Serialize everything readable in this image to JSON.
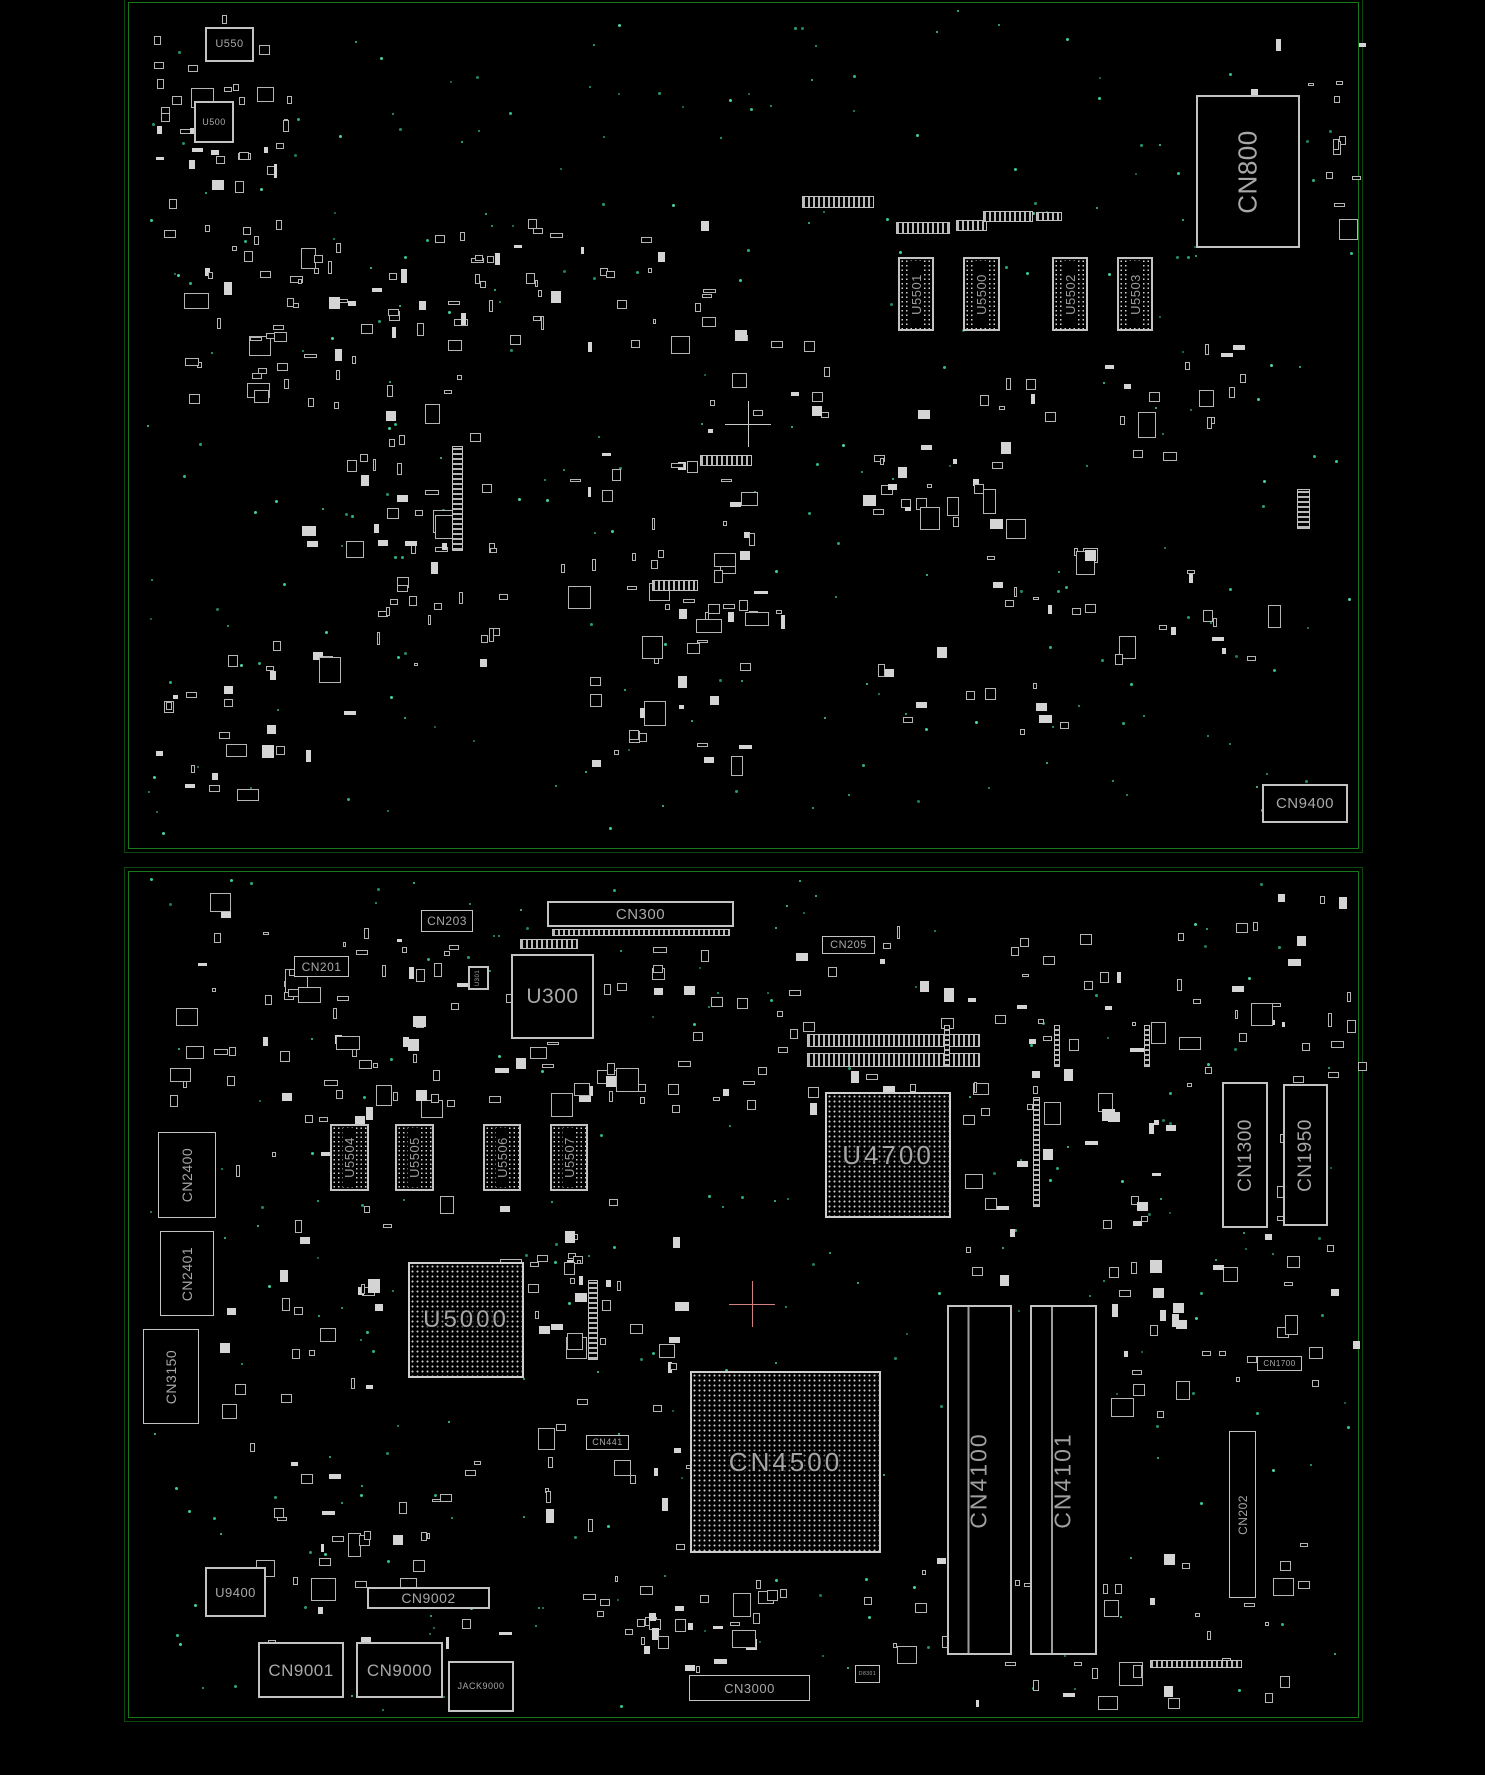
{
  "colors": {
    "background": "#000000",
    "frame_green": "#16781b",
    "frame_green_dim": "#0b470e",
    "component_gray": "#c3c3c3",
    "label_gray": "#a8a8a8",
    "via_teal": "#2fa37a",
    "crosshair_top": "#c7cbc7",
    "crosshair_bottom": "#d4827e"
  },
  "boards": [
    {
      "name": "top-board",
      "frame": {
        "x": 128,
        "y": 2,
        "w": 1229,
        "h": 845
      },
      "crosshair": {
        "x": 748,
        "y": 424,
        "color": "#c7cbc7"
      },
      "components": [
        {
          "id": "u550",
          "label": "U550",
          "type": "chip",
          "x": 205,
          "y": 27,
          "w": 49,
          "h": 35,
          "fs": 11,
          "o": "h"
        },
        {
          "id": "u500",
          "label": "U500",
          "type": "chip",
          "x": 194,
          "y": 101,
          "w": 40,
          "h": 42,
          "fs": 9,
          "o": "h"
        },
        {
          "id": "cn800",
          "label": "CN800",
          "type": "conn",
          "x": 1196,
          "y": 95,
          "w": 104,
          "h": 153,
          "fs": 26,
          "o": "v",
          "bw": 2
        },
        {
          "id": "u5501",
          "label": "U5501",
          "type": "dimm",
          "x": 898,
          "y": 257,
          "w": 36,
          "h": 74,
          "fs": 13,
          "o": "v"
        },
        {
          "id": "u5500",
          "label": "U5500",
          "type": "dimm",
          "x": 963,
          "y": 257,
          "w": 37,
          "h": 74,
          "fs": 13,
          "o": "v"
        },
        {
          "id": "u5502",
          "label": "U5502",
          "type": "dimm",
          "x": 1052,
          "y": 257,
          "w": 36,
          "h": 74,
          "fs": 13,
          "o": "v"
        },
        {
          "id": "u5503",
          "label": "U5503",
          "type": "dimm",
          "x": 1117,
          "y": 257,
          "w": 36,
          "h": 74,
          "fs": 13,
          "o": "v"
        },
        {
          "id": "cn9400",
          "label": "CN9400",
          "type": "conn",
          "x": 1262,
          "y": 784,
          "w": 86,
          "h": 39,
          "fs": 15,
          "o": "h",
          "bw": 2
        }
      ],
      "pin_strips": [
        {
          "x": 802,
          "y": 196,
          "w": 72,
          "h": 12,
          "o": "h"
        },
        {
          "x": 896,
          "y": 222,
          "w": 54,
          "h": 12,
          "o": "h"
        },
        {
          "x": 956,
          "y": 220,
          "w": 31,
          "h": 11,
          "o": "h"
        },
        {
          "x": 983,
          "y": 211,
          "w": 50,
          "h": 11,
          "o": "h"
        },
        {
          "x": 1036,
          "y": 212,
          "w": 26,
          "h": 9,
          "o": "h"
        },
        {
          "x": 700,
          "y": 455,
          "w": 52,
          "h": 11,
          "o": "h"
        },
        {
          "x": 652,
          "y": 580,
          "w": 46,
          "h": 11,
          "o": "h"
        },
        {
          "x": 452,
          "y": 446,
          "w": 11,
          "h": 105,
          "o": "v"
        },
        {
          "x": 1297,
          "y": 489,
          "w": 13,
          "h": 40,
          "o": "v"
        }
      ],
      "scatter": [
        {
          "x": 150,
          "y": 15,
          "w": 140,
          "h": 240,
          "n": 46,
          "seed": 101
        },
        {
          "x": 160,
          "y": 260,
          "w": 130,
          "h": 140,
          "n": 20,
          "seed": 102
        },
        {
          "x": 255,
          "y": 240,
          "w": 170,
          "h": 120,
          "n": 24,
          "seed": 103
        },
        {
          "x": 300,
          "y": 370,
          "w": 190,
          "h": 180,
          "n": 26,
          "seed": 104
        },
        {
          "x": 370,
          "y": 430,
          "w": 130,
          "h": 250,
          "n": 30,
          "seed": 105
        },
        {
          "x": 430,
          "y": 215,
          "w": 280,
          "h": 130,
          "n": 40,
          "seed": 106
        },
        {
          "x": 560,
          "y": 420,
          "w": 190,
          "h": 200,
          "n": 30,
          "seed": 107
        },
        {
          "x": 640,
          "y": 560,
          "w": 160,
          "h": 120,
          "n": 18,
          "seed": 108
        },
        {
          "x": 700,
          "y": 330,
          "w": 130,
          "h": 100,
          "n": 12,
          "seed": 109
        },
        {
          "x": 850,
          "y": 370,
          "w": 240,
          "h": 150,
          "n": 30,
          "seed": 110
        },
        {
          "x": 980,
          "y": 540,
          "w": 140,
          "h": 120,
          "n": 14,
          "seed": 111
        },
        {
          "x": 1090,
          "y": 330,
          "w": 190,
          "h": 130,
          "n": 16,
          "seed": 112
        },
        {
          "x": 1240,
          "y": 30,
          "w": 120,
          "h": 200,
          "n": 16,
          "seed": 113
        },
        {
          "x": 1150,
          "y": 560,
          "w": 120,
          "h": 100,
          "n": 10,
          "seed": 114
        },
        {
          "x": 155,
          "y": 620,
          "w": 200,
          "h": 170,
          "n": 26,
          "seed": 115
        },
        {
          "x": 540,
          "y": 660,
          "w": 200,
          "h": 110,
          "n": 16,
          "seed": 116
        },
        {
          "x": 860,
          "y": 630,
          "w": 200,
          "h": 100,
          "n": 12,
          "seed": 117
        }
      ],
      "vias": {
        "x": 140,
        "y": 8,
        "w": 1210,
        "h": 832,
        "n": 240,
        "seed": 151
      }
    },
    {
      "name": "bottom-board",
      "frame": {
        "x": 128,
        "y": 871,
        "w": 1229,
        "h": 845
      },
      "crosshair": {
        "x": 752,
        "y": 1304,
        "color": "#d4827e"
      },
      "components": [
        {
          "id": "cn300",
          "label": "CN300",
          "type": "conn",
          "x": 547,
          "y": 901,
          "w": 187,
          "h": 26,
          "fs": 15,
          "o": "h",
          "bw": 2
        },
        {
          "id": "cn203",
          "label": "CN203",
          "type": "conn",
          "x": 421,
          "y": 910,
          "w": 52,
          "h": 22,
          "fs": 12,
          "o": "h"
        },
        {
          "id": "cn201",
          "label": "CN201",
          "type": "conn",
          "x": 294,
          "y": 956,
          "w": 55,
          "h": 21,
          "fs": 12,
          "o": "h"
        },
        {
          "id": "u300",
          "label": "U300",
          "type": "chip",
          "x": 511,
          "y": 954,
          "w": 83,
          "h": 85,
          "fs": 21,
          "o": "h",
          "bw": 2
        },
        {
          "id": "u301",
          "label": "U301",
          "type": "chip",
          "x": 468,
          "y": 966,
          "w": 21,
          "h": 24,
          "fs": 6,
          "o": "v"
        },
        {
          "id": "cn205",
          "label": "CN205",
          "type": "conn",
          "x": 822,
          "y": 936,
          "w": 53,
          "h": 18,
          "fs": 11,
          "o": "h"
        },
        {
          "id": "u5504",
          "label": "U5504",
          "type": "dimm",
          "x": 330,
          "y": 1124,
          "w": 39,
          "h": 67,
          "fs": 13,
          "o": "v"
        },
        {
          "id": "u5505",
          "label": "U5505",
          "type": "dimm",
          "x": 395,
          "y": 1124,
          "w": 39,
          "h": 67,
          "fs": 13,
          "o": "v"
        },
        {
          "id": "u5506",
          "label": "U5506",
          "type": "dimm",
          "x": 483,
          "y": 1124,
          "w": 38,
          "h": 67,
          "fs": 13,
          "o": "v"
        },
        {
          "id": "u5507",
          "label": "U5507",
          "type": "dimm",
          "x": 550,
          "y": 1124,
          "w": 38,
          "h": 67,
          "fs": 13,
          "o": "v"
        },
        {
          "id": "u4700",
          "label": "U4700",
          "type": "bga",
          "x": 825,
          "y": 1092,
          "w": 126,
          "h": 126,
          "fs": 26,
          "o": "h"
        },
        {
          "id": "cn1300",
          "label": "CN1300",
          "type": "conn",
          "x": 1222,
          "y": 1082,
          "w": 46,
          "h": 146,
          "fs": 19,
          "o": "v",
          "bw": 2
        },
        {
          "id": "cn1950",
          "label": "CN1950",
          "type": "conn",
          "x": 1283,
          "y": 1084,
          "w": 45,
          "h": 142,
          "fs": 19,
          "o": "v",
          "bw": 2
        },
        {
          "id": "cn2400",
          "label": "CN2400",
          "type": "conn",
          "x": 158,
          "y": 1132,
          "w": 58,
          "h": 86,
          "fs": 14,
          "o": "v"
        },
        {
          "id": "cn2401",
          "label": "CN2401",
          "type": "conn",
          "x": 160,
          "y": 1231,
          "w": 54,
          "h": 85,
          "fs": 14,
          "o": "v"
        },
        {
          "id": "cn3150",
          "label": "CN3150",
          "type": "conn",
          "x": 143,
          "y": 1329,
          "w": 56,
          "h": 95,
          "fs": 14,
          "o": "v"
        },
        {
          "id": "u5000",
          "label": "U5000",
          "type": "bga",
          "x": 408,
          "y": 1262,
          "w": 116,
          "h": 116,
          "fs": 24,
          "o": "h"
        },
        {
          "id": "cn441",
          "label": "CN441",
          "type": "tag",
          "x": 586,
          "y": 1435,
          "w": 43,
          "h": 15,
          "fs": 9,
          "o": "h"
        },
        {
          "id": "cn4500",
          "label": "CN4500",
          "type": "bga",
          "x": 690,
          "y": 1371,
          "w": 191,
          "h": 182,
          "fs": 26,
          "o": "h"
        },
        {
          "id": "cn4100",
          "label": "CN4100",
          "type": "slot",
          "x": 947,
          "y": 1305,
          "w": 65,
          "h": 350,
          "fs": 23,
          "o": "v"
        },
        {
          "id": "cn4101",
          "label": "CN4101",
          "type": "slot",
          "x": 1030,
          "y": 1305,
          "w": 67,
          "h": 350,
          "fs": 23,
          "o": "v"
        },
        {
          "id": "cn202",
          "label": "CN202",
          "type": "conn",
          "x": 1229,
          "y": 1431,
          "w": 27,
          "h": 167,
          "fs": 12,
          "o": "v"
        },
        {
          "id": "cn1700",
          "label": "CN1700",
          "type": "tag",
          "x": 1257,
          "y": 1356,
          "w": 45,
          "h": 15,
          "fs": 8,
          "o": "h"
        },
        {
          "id": "u9400",
          "label": "U9400",
          "type": "chip",
          "x": 205,
          "y": 1567,
          "w": 61,
          "h": 50,
          "fs": 13,
          "o": "h"
        },
        {
          "id": "cn9002",
          "label": "CN9002",
          "type": "conn",
          "x": 367,
          "y": 1587,
          "w": 123,
          "h": 22,
          "fs": 14,
          "o": "h",
          "bw": 2
        },
        {
          "id": "cn9001",
          "label": "CN9001",
          "type": "conn",
          "x": 258,
          "y": 1642,
          "w": 86,
          "h": 56,
          "fs": 17,
          "o": "h",
          "bw": 2
        },
        {
          "id": "cn9000",
          "label": "CN9000",
          "type": "conn",
          "x": 356,
          "y": 1642,
          "w": 87,
          "h": 56,
          "fs": 17,
          "o": "h",
          "bw": 2
        },
        {
          "id": "jack9000",
          "label": "JACK9000",
          "type": "conn",
          "x": 448,
          "y": 1661,
          "w": 66,
          "h": 51,
          "fs": 9,
          "o": "h",
          "bw": 2
        },
        {
          "id": "cn3000",
          "label": "CN3000",
          "type": "conn",
          "x": 689,
          "y": 1675,
          "w": 121,
          "h": 26,
          "fs": 13,
          "o": "h"
        },
        {
          "id": "d8301",
          "label": "D8301",
          "type": "tag",
          "x": 855,
          "y": 1665,
          "w": 25,
          "h": 18,
          "fs": 5,
          "o": "h"
        }
      ],
      "pin_strips": [
        {
          "x": 552,
          "y": 929,
          "w": 178,
          "h": 7,
          "o": "h"
        },
        {
          "x": 520,
          "y": 939,
          "w": 58,
          "h": 10,
          "o": "h"
        },
        {
          "x": 807,
          "y": 1034,
          "w": 173,
          "h": 13,
          "o": "h"
        },
        {
          "x": 807,
          "y": 1053,
          "w": 173,
          "h": 14,
          "o": "h"
        },
        {
          "x": 1150,
          "y": 1660,
          "w": 92,
          "h": 8,
          "o": "h"
        },
        {
          "x": 944,
          "y": 1025,
          "w": 6,
          "h": 42,
          "o": "v"
        },
        {
          "x": 1054,
          "y": 1025,
          "w": 6,
          "h": 42,
          "o": "v"
        },
        {
          "x": 1144,
          "y": 1025,
          "w": 6,
          "h": 42,
          "o": "v"
        },
        {
          "x": 1033,
          "y": 1097,
          "w": 7,
          "h": 110,
          "o": "v"
        },
        {
          "x": 588,
          "y": 1280,
          "w": 10,
          "h": 80,
          "o": "v"
        }
      ],
      "scatter": [
        {
          "x": 170,
          "y": 890,
          "w": 260,
          "h": 210,
          "n": 42,
          "seed": 201
        },
        {
          "x": 300,
          "y": 1030,
          "w": 150,
          "h": 90,
          "n": 14,
          "seed": 202
        },
        {
          "x": 430,
          "y": 930,
          "w": 180,
          "h": 170,
          "n": 26,
          "seed": 203
        },
        {
          "x": 600,
          "y": 925,
          "w": 300,
          "h": 190,
          "n": 44,
          "seed": 204
        },
        {
          "x": 900,
          "y": 925,
          "w": 290,
          "h": 200,
          "n": 44,
          "seed": 205
        },
        {
          "x": 1160,
          "y": 885,
          "w": 200,
          "h": 210,
          "n": 30,
          "seed": 206
        },
        {
          "x": 215,
          "y": 1150,
          "w": 170,
          "h": 260,
          "n": 28,
          "seed": 207
        },
        {
          "x": 440,
          "y": 1180,
          "w": 170,
          "h": 150,
          "n": 20,
          "seed": 208
        },
        {
          "x": 530,
          "y": 1230,
          "w": 150,
          "h": 230,
          "n": 28,
          "seed": 209
        },
        {
          "x": 960,
          "y": 1140,
          "w": 200,
          "h": 150,
          "n": 20,
          "seed": 210
        },
        {
          "x": 1060,
          "y": 1260,
          "w": 190,
          "h": 190,
          "n": 22,
          "seed": 211
        },
        {
          "x": 240,
          "y": 1440,
          "w": 260,
          "h": 200,
          "n": 34,
          "seed": 212
        },
        {
          "x": 540,
          "y": 1450,
          "w": 230,
          "h": 200,
          "n": 30,
          "seed": 213
        },
        {
          "x": 860,
          "y": 1555,
          "w": 260,
          "h": 150,
          "n": 22,
          "seed": 214
        },
        {
          "x": 1060,
          "y": 1540,
          "w": 260,
          "h": 160,
          "n": 22,
          "seed": 215
        },
        {
          "x": 1255,
          "y": 1120,
          "w": 110,
          "h": 280,
          "n": 14,
          "seed": 216
        },
        {
          "x": 620,
          "y": 1560,
          "w": 180,
          "h": 110,
          "n": 16,
          "seed": 217
        }
      ],
      "vias": {
        "x": 140,
        "y": 877,
        "w": 1210,
        "h": 832,
        "n": 260,
        "seed": 251
      }
    }
  ]
}
